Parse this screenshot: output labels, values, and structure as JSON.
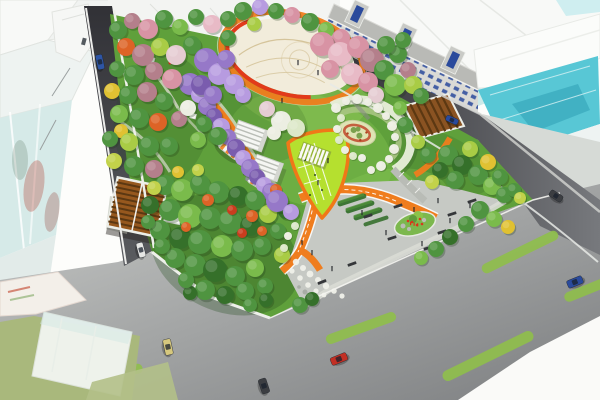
{
  "meta": {
    "title": "Aerial rendering of an urban pocket-park landscape design",
    "view": "bird's-eye perspective, no visible text in image"
  },
  "palette": {
    "bg": "#fdfdfb",
    "bldg_white": "#f8f9f7",
    "bldg_white2": "#f1f3f1",
    "bldg_edge": "#e2e4e0",
    "glass_pale": "#d6eae8",
    "glass_teal": "#58c7d5",
    "glass_teal_dark": "#2f9fb4",
    "glass_teal_band": "#cdeae9",
    "red_reflection": "#b03524",
    "row_roof": "#b9bab6",
    "row_face": "#dadad6",
    "window_blue": "#2a4a9c",
    "road_dark_a": "#313136",
    "road_dark_b": "#77797d",
    "road_light_a": "#c8cac8",
    "road_light_b": "#7c7e80",
    "sidewalk": "#e9ebe6",
    "olive_lot": "#a9b87c",
    "lawn": "#5fa03b",
    "lawn_light": "#7ebf4e",
    "lawn_bright": "#9ed162",
    "lawn_dark": "#234c1e",
    "plaza_cream": "#f2ecdb",
    "plaza_line": "#d2c094",
    "ring_orange": "#ef7d1e",
    "ring_red": "#e23a1a",
    "playground_lime": "#b5e02f",
    "playground_border": "#f07818",
    "hedge_dark": "#2e6b26",
    "hedge_light": "#4e8f3a",
    "spiral_pale": "#e9efdb",
    "spiral_vine": "#a9c583",
    "spiral_bed": "#dfe3b4",
    "spiral_red": "#c25032",
    "pergola_brown": "#96581e",
    "pergola_slat": "#5c3812",
    "pavilion_white": "#f5f6f3",
    "island_green": "#7cb84e",
    "flower_white": "#f0f1ea",
    "lane_stripe": "#8fbf4a",
    "tunnel_path": "#e8e4da",
    "g": "#4f9440",
    "lg": "#7abb4b",
    "dg": "#35702a",
    "li": "#a9cc45",
    "yl": "#e0c132",
    "yg": "#c2d24a",
    "or": "#dd6326",
    "ro": "#c93d1e",
    "pk": "#d893a4",
    "pl": "#e8bac6",
    "mv": "#b47f8b",
    "pp": "#e5ccd2",
    "pu": "#9678c8",
    "pU": "#b79be0",
    "pd": "#7a5cae",
    "wt": "#eceee2",
    "wg": "#dce8c8",
    "car_blue": "#2e55a5",
    "car_blue2": "#2a4a9c",
    "car_white": "#e6e7e5",
    "car_yellow": "#d6c87e",
    "car_red": "#c22f24",
    "car_dark": "#3c3e42"
  },
  "scene": {
    "trees": [
      [
        118,
        30,
        9,
        "g"
      ],
      [
        132,
        21,
        8,
        "mv"
      ],
      [
        148,
        29,
        10,
        "pk"
      ],
      [
        164,
        19,
        9,
        "g"
      ],
      [
        180,
        27,
        8,
        "lg"
      ],
      [
        196,
        17,
        8,
        "g"
      ],
      [
        212,
        24,
        9,
        "pl"
      ],
      [
        228,
        19,
        8,
        "g"
      ],
      [
        126,
        47,
        9,
        "or"
      ],
      [
        143,
        55,
        11,
        "mv"
      ],
      [
        160,
        47,
        9,
        "li"
      ],
      [
        176,
        55,
        10,
        "pp"
      ],
      [
        192,
        45,
        9,
        "g"
      ],
      [
        117,
        69,
        8,
        "g"
      ],
      [
        134,
        75,
        10,
        "g"
      ],
      [
        154,
        71,
        9,
        "mv"
      ],
      [
        172,
        79,
        10,
        "pk"
      ],
      [
        112,
        91,
        8,
        "yl"
      ],
      [
        128,
        95,
        9,
        "g"
      ],
      [
        147,
        92,
        10,
        "mv"
      ],
      [
        164,
        101,
        9,
        "g"
      ],
      [
        119,
        114,
        9,
        "lg"
      ],
      [
        139,
        118,
        10,
        "g"
      ],
      [
        158,
        122,
        9,
        "or"
      ],
      [
        179,
        119,
        8,
        "mv"
      ],
      [
        121,
        131,
        7,
        "yl"
      ],
      [
        110,
        139,
        8,
        "g"
      ],
      [
        129,
        142,
        9,
        "li"
      ],
      [
        149,
        146,
        10,
        "g"
      ],
      [
        169,
        146,
        9,
        "g"
      ],
      [
        114,
        161,
        8,
        "yg"
      ],
      [
        134,
        166,
        10,
        "g"
      ],
      [
        154,
        169,
        9,
        "mv"
      ],
      [
        188,
        108,
        8,
        "wt"
      ],
      [
        204,
        124,
        8,
        "g"
      ],
      [
        218,
        136,
        9,
        "g"
      ],
      [
        198,
        140,
        8,
        "lg"
      ],
      [
        206,
        60,
        12,
        "pu"
      ],
      [
        219,
        74,
        11,
        "pU"
      ],
      [
        201,
        85,
        10,
        "pd"
      ],
      [
        226,
        59,
        9,
        "pu"
      ],
      [
        234,
        84,
        10,
        "pU"
      ],
      [
        213,
        95,
        9,
        "pu"
      ],
      [
        243,
        95,
        8,
        "pU"
      ],
      [
        243,
        11,
        9,
        "g"
      ],
      [
        260,
        7,
        8,
        "pU"
      ],
      [
        276,
        11,
        8,
        "g"
      ],
      [
        292,
        15,
        8,
        "pk"
      ],
      [
        310,
        22,
        9,
        "g"
      ],
      [
        326,
        30,
        8,
        "lg"
      ],
      [
        341,
        38,
        9,
        "pk"
      ],
      [
        254,
        24,
        7,
        "li"
      ],
      [
        228,
        38,
        8,
        "g"
      ],
      [
        322,
        44,
        12,
        "pk"
      ],
      [
        340,
        54,
        12,
        "pl"
      ],
      [
        358,
        47,
        11,
        "pk"
      ],
      [
        372,
        60,
        12,
        "mv"
      ],
      [
        352,
        74,
        11,
        "pl"
      ],
      [
        368,
        82,
        10,
        "pk"
      ],
      [
        384,
        70,
        10,
        "g"
      ],
      [
        395,
        85,
        11,
        "lg"
      ],
      [
        330,
        69,
        9,
        "pk"
      ],
      [
        398,
        54,
        9,
        "g"
      ],
      [
        408,
        70,
        8,
        "mv"
      ],
      [
        386,
        45,
        9,
        "g"
      ],
      [
        403,
        40,
        8,
        "g"
      ],
      [
        413,
        85,
        9,
        "li"
      ],
      [
        421,
        96,
        8,
        "g"
      ],
      [
        376,
        95,
        8,
        "pp"
      ],
      [
        281,
        121,
        10,
        "wt"
      ],
      [
        296,
        128,
        9,
        "wg"
      ],
      [
        267,
        109,
        8,
        "pp"
      ],
      [
        274,
        133,
        7,
        "wt"
      ],
      [
        405,
        125,
        8,
        "g"
      ],
      [
        418,
        142,
        7,
        "li"
      ],
      [
        428,
        155,
        8,
        "g"
      ],
      [
        400,
        108,
        7,
        "lg"
      ],
      [
        448,
        155,
        10,
        "g"
      ],
      [
        462,
        165,
        10,
        "dg"
      ],
      [
        478,
        175,
        10,
        "g"
      ],
      [
        492,
        186,
        9,
        "lg"
      ],
      [
        504,
        195,
        8,
        "g"
      ],
      [
        470,
        149,
        8,
        "li"
      ],
      [
        488,
        162,
        8,
        "yl"
      ],
      [
        500,
        177,
        8,
        "g"
      ],
      [
        514,
        190,
        7,
        "g"
      ],
      [
        455,
        180,
        9,
        "g"
      ],
      [
        440,
        170,
        8,
        "dg"
      ],
      [
        432,
        182,
        7,
        "yg"
      ],
      [
        520,
        198,
        6,
        "yg"
      ],
      [
        165,
        185,
        10,
        "g"
      ],
      [
        182,
        190,
        11,
        "lg"
      ],
      [
        200,
        184,
        10,
        "g"
      ],
      [
        218,
        192,
        11,
        "g"
      ],
      [
        238,
        196,
        10,
        "dg"
      ],
      [
        255,
        200,
        10,
        "g"
      ],
      [
        150,
        205,
        9,
        "dg"
      ],
      [
        170,
        210,
        11,
        "g"
      ],
      [
        190,
        216,
        12,
        "lg"
      ],
      [
        210,
        218,
        11,
        "g"
      ],
      [
        230,
        222,
        12,
        "g"
      ],
      [
        250,
        226,
        10,
        "dg"
      ],
      [
        268,
        214,
        9,
        "li"
      ],
      [
        160,
        230,
        10,
        "g"
      ],
      [
        180,
        238,
        11,
        "dg"
      ],
      [
        200,
        242,
        12,
        "g"
      ],
      [
        222,
        246,
        11,
        "lg"
      ],
      [
        242,
        250,
        11,
        "g"
      ],
      [
        262,
        246,
        9,
        "g"
      ],
      [
        175,
        258,
        10,
        "g"
      ],
      [
        195,
        265,
        11,
        "g"
      ],
      [
        215,
        270,
        12,
        "dg"
      ],
      [
        235,
        276,
        10,
        "g"
      ],
      [
        255,
        268,
        9,
        "lg"
      ],
      [
        205,
        290,
        10,
        "g"
      ],
      [
        225,
        295,
        9,
        "dg"
      ],
      [
        245,
        291,
        9,
        "g"
      ],
      [
        265,
        286,
        8,
        "g"
      ],
      [
        190,
        293,
        7,
        "dg"
      ],
      [
        250,
        305,
        7,
        "g"
      ],
      [
        266,
        300,
        7,
        "dg"
      ],
      [
        282,
        255,
        8,
        "li"
      ],
      [
        278,
        231,
        8,
        "g"
      ],
      [
        286,
        211,
        8,
        "dg"
      ],
      [
        208,
        200,
        6,
        "or"
      ],
      [
        232,
        210,
        5,
        "ro"
      ],
      [
        252,
        216,
        6,
        "or"
      ],
      [
        276,
        190,
        6,
        "or"
      ],
      [
        262,
        231,
        5,
        "or"
      ],
      [
        242,
        233,
        5,
        "ro"
      ],
      [
        186,
        227,
        5,
        "or"
      ],
      [
        178,
        172,
        6,
        "yl"
      ],
      [
        198,
        170,
        6,
        "yg"
      ],
      [
        154,
        188,
        7,
        "yg"
      ],
      [
        148,
        222,
        7,
        "g"
      ],
      [
        162,
        246,
        8,
        "g"
      ],
      [
        186,
        280,
        8,
        "g"
      ],
      [
        277,
        201,
        11,
        "pu"
      ],
      [
        291,
        212,
        8,
        "pU"
      ],
      [
        480,
        210,
        9,
        "g"
      ],
      [
        494,
        219,
        8,
        "lg"
      ],
      [
        508,
        227,
        7,
        "yl"
      ],
      [
        466,
        224,
        8,
        "g"
      ],
      [
        450,
        237,
        8,
        "dg"
      ],
      [
        436,
        249,
        8,
        "g"
      ],
      [
        421,
        258,
        7,
        "lg"
      ],
      [
        300,
        305,
        8,
        "g"
      ],
      [
        312,
        299,
        7,
        "dg"
      ],
      [
        336,
        108,
        5,
        "wt"
      ],
      [
        346,
        101,
        4,
        "wt"
      ],
      [
        357,
        99,
        5,
        "wt"
      ],
      [
        368,
        102,
        4,
        "wt"
      ],
      [
        378,
        108,
        5,
        "wt"
      ],
      [
        386,
        116,
        4,
        "wt"
      ],
      [
        392,
        126,
        5,
        "wt"
      ],
      [
        395,
        137,
        4,
        "wt"
      ],
      [
        394,
        149,
        5,
        "wt"
      ],
      [
        389,
        159,
        4,
        "wt"
      ],
      [
        381,
        166,
        5,
        "wt"
      ],
      [
        371,
        170,
        4,
        "wt"
      ],
      [
        341,
        118,
        4,
        "wg"
      ],
      [
        337,
        129,
        4,
        "wt"
      ],
      [
        339,
        140,
        4,
        "wg"
      ],
      [
        345,
        150,
        4,
        "wt"
      ],
      [
        353,
        156,
        4,
        "wg"
      ],
      [
        362,
        158,
        4,
        "wt"
      ],
      [
        295,
        226,
        4,
        "wg"
      ],
      [
        288,
        236,
        4,
        "wt"
      ],
      [
        284,
        248,
        4,
        "wg"
      ]
    ],
    "tunnel_blossoms": [
      [
        190,
        84,
        11,
        "pu"
      ],
      [
        199,
        95,
        8,
        "pU"
      ],
      [
        207,
        106,
        9,
        "pu"
      ],
      [
        214,
        116,
        8,
        "pd"
      ],
      [
        221,
        127,
        9,
        "pU"
      ],
      [
        228,
        137,
        8,
        "pu"
      ],
      [
        236,
        148,
        9,
        "pd"
      ],
      [
        243,
        158,
        8,
        "pU"
      ],
      [
        250,
        168,
        9,
        "pu"
      ],
      [
        257,
        177,
        8,
        "pd"
      ],
      [
        264,
        185,
        8,
        "pU"
      ],
      [
        271,
        192,
        9,
        "pu"
      ],
      [
        277,
        199,
        7,
        "pU"
      ]
    ],
    "cars": [
      [
        100,
        62,
        78,
        15,
        7,
        "car_blue"
      ],
      [
        141,
        250,
        75,
        15,
        7,
        "car_white"
      ],
      [
        168,
        347,
        78,
        16,
        8,
        "car_yellow"
      ],
      [
        264,
        386,
        72,
        15,
        8,
        "car_dark"
      ],
      [
        339,
        359,
        -22,
        17,
        8,
        "car_red"
      ],
      [
        575,
        282,
        -22,
        16,
        8,
        "car_blue2"
      ],
      [
        452,
        120,
        25,
        13,
        6,
        "car_blue2"
      ],
      [
        556,
        196,
        33,
        14,
        7,
        "car_dark"
      ]
    ],
    "lane_stripes": [
      [
        520,
        252,
        84,
        10,
        -26
      ],
      [
        586,
        290,
        46,
        10,
        -22
      ],
      [
        361,
        328,
        74,
        10,
        -20
      ],
      [
        488,
        356,
        100,
        11,
        -26
      ],
      [
        100,
        374,
        86,
        10,
        -8
      ]
    ],
    "benches": [
      [
        368,
        216,
        -18
      ],
      [
        392,
        238,
        -18
      ],
      [
        428,
        248,
        -18
      ],
      [
        452,
        214,
        -18
      ],
      [
        472,
        201,
        -18
      ],
      [
        352,
        264,
        -20
      ],
      [
        322,
        282,
        -22
      ],
      [
        398,
        206,
        -18
      ],
      [
        442,
        232,
        -18
      ]
    ],
    "people": [
      [
        362,
        212
      ],
      [
        386,
        232
      ],
      [
        422,
        243
      ],
      [
        450,
        220
      ],
      [
        332,
        268
      ],
      [
        312,
        252
      ],
      [
        302,
        242
      ],
      [
        414,
        209
      ],
      [
        438,
        200
      ],
      [
        470,
        205
      ],
      [
        328,
        160
      ],
      [
        318,
        182
      ],
      [
        256,
        196
      ],
      [
        244,
        172
      ],
      [
        298,
        62
      ],
      [
        318,
        72
      ],
      [
        282,
        100
      ]
    ]
  }
}
